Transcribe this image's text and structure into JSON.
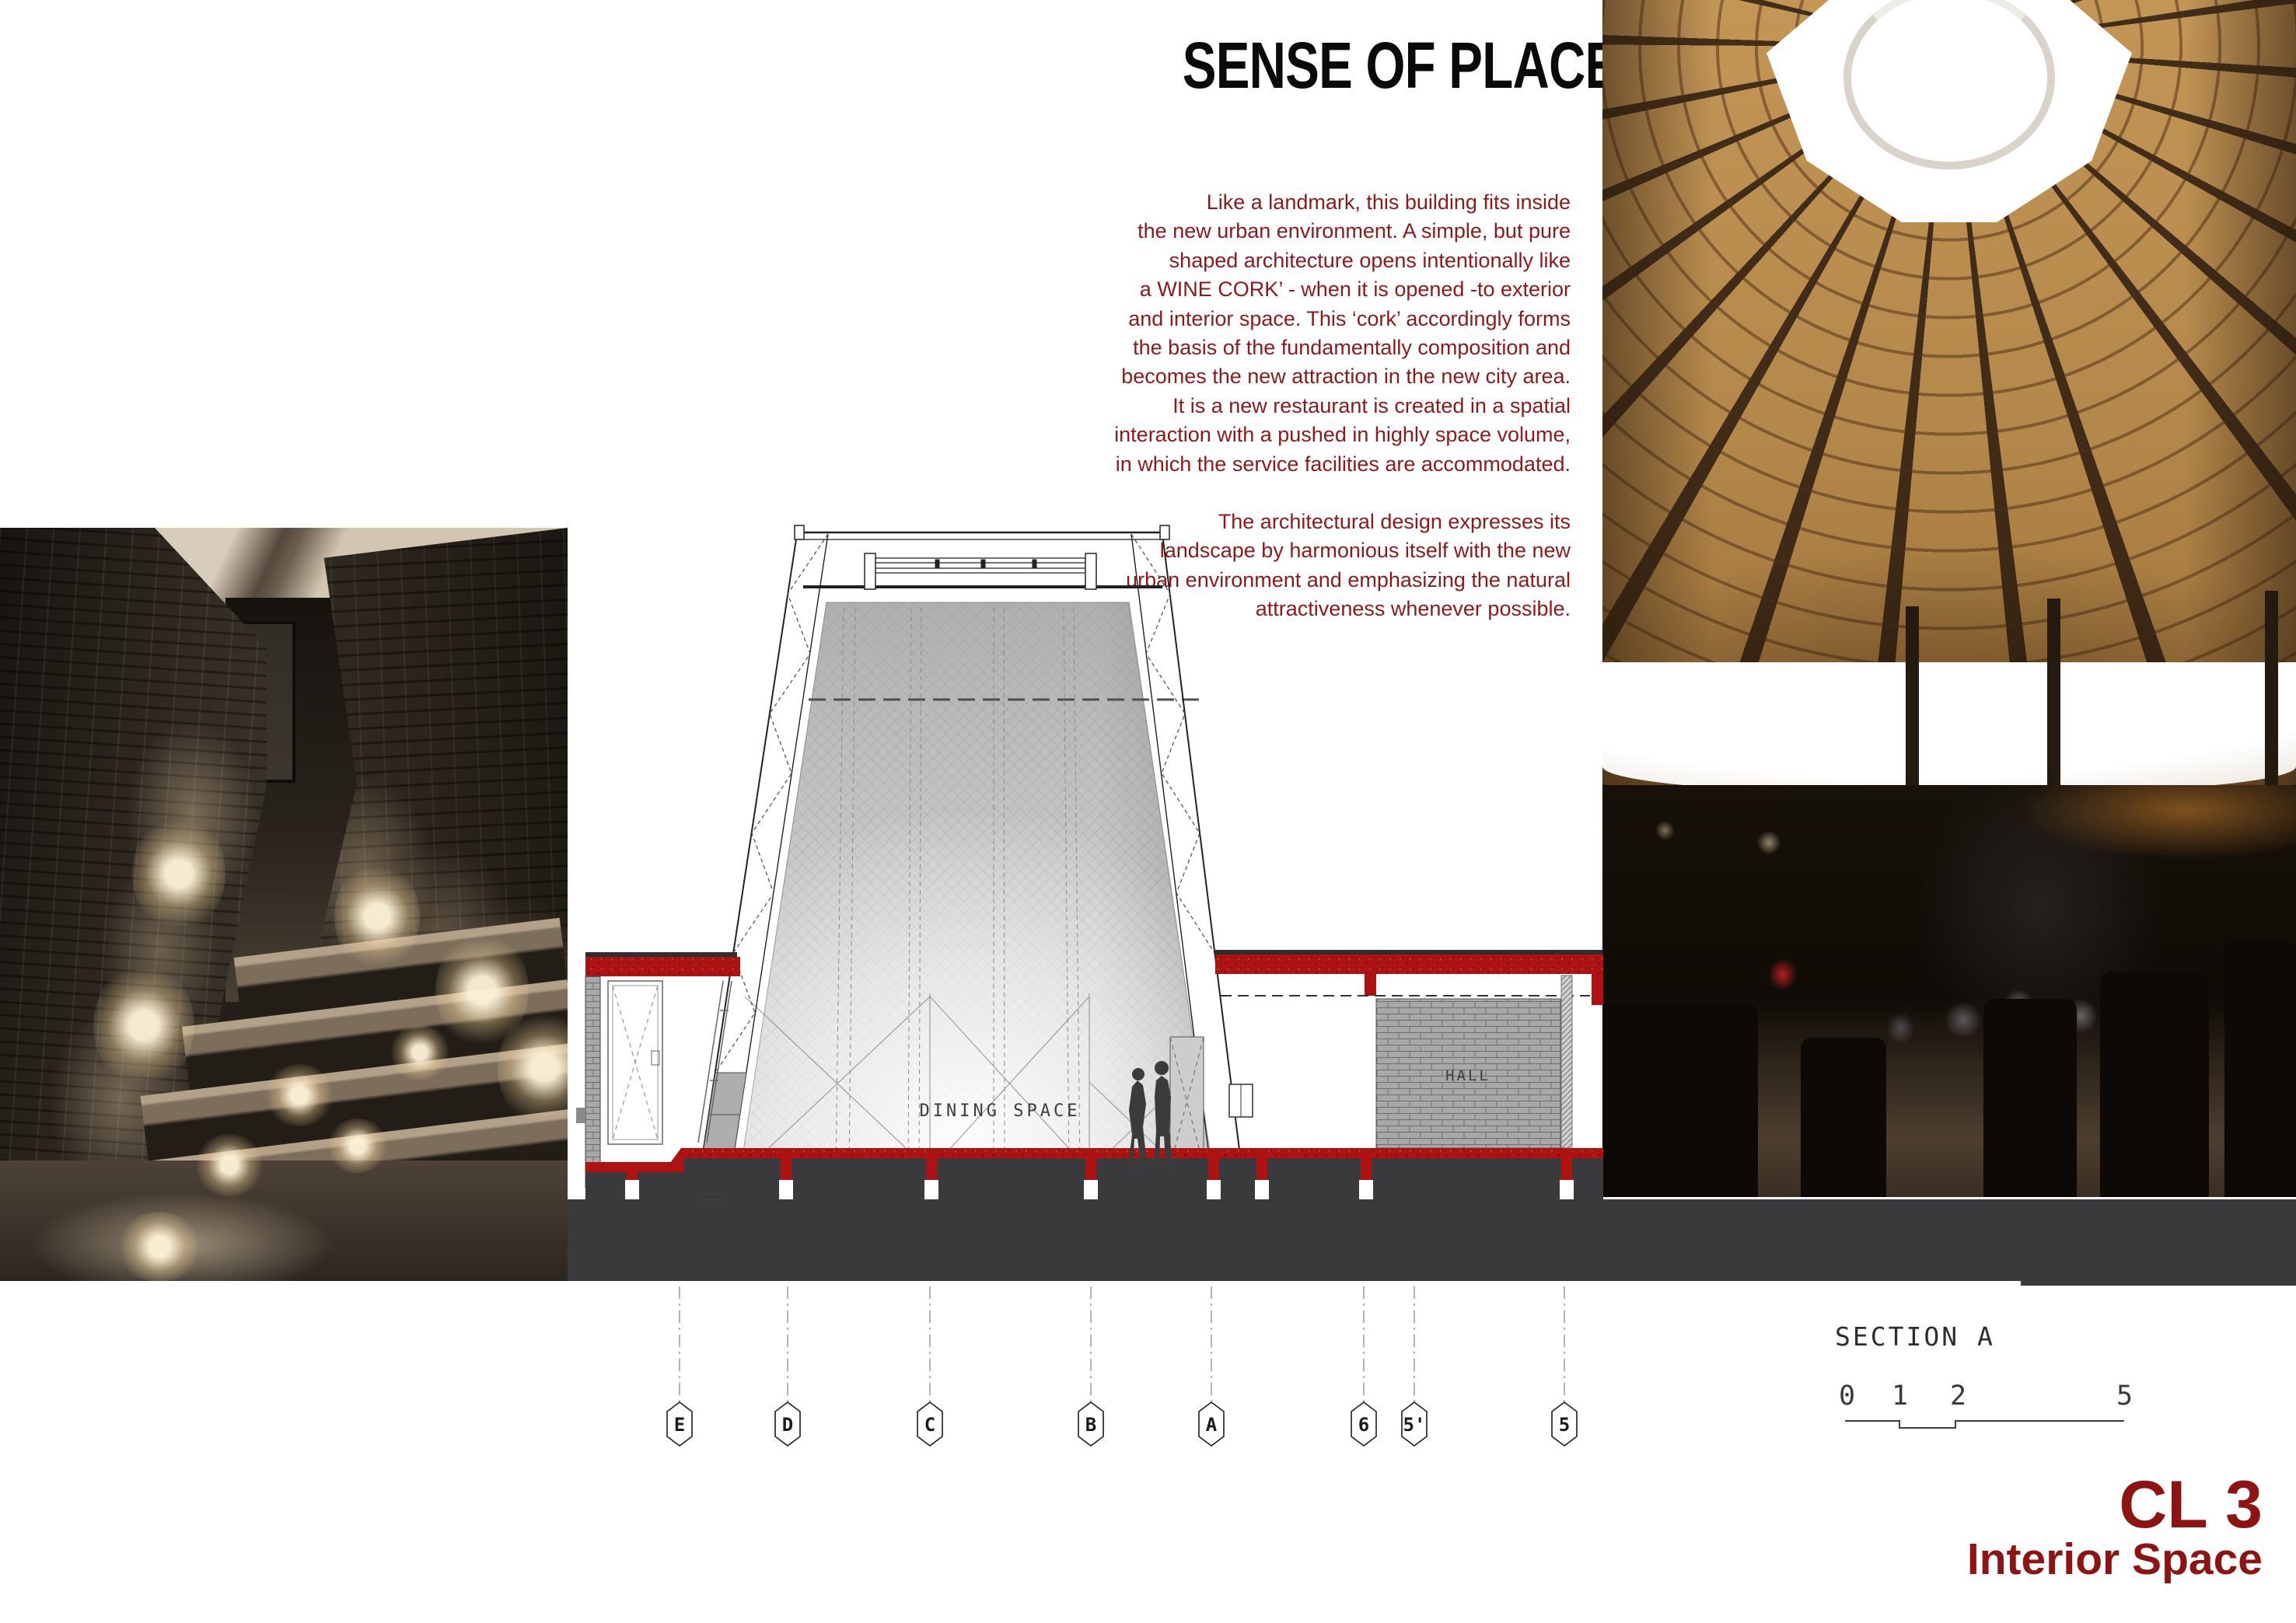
{
  "title": "SENSE OF PLACE",
  "intro": {
    "color": "#8C1A1A",
    "p1": [
      "Like a landmark, this building fits inside",
      "the new urban environment. A simple, but pure",
      "shaped architecture opens intentionally like",
      "a WINE CORK’ - when it is opened -to exterior",
      "and interior space. This ‘cork’ accordingly forms",
      "the basis of the fundamentally composition and",
      "becomes the new attraction in the new city area.",
      "It is a new restaurant is created in a spatial",
      "interaction with a pushed in highly space volume,",
      "in which the service facilities are accommodated."
    ],
    "p2": [
      "The architectural design expresses its",
      "landscape by harmonious itself with the new",
      "urban environment and emphasizing the natural",
      "attractiveness whenever possible."
    ]
  },
  "drawing": {
    "room_labels": {
      "dining": "DINING SPACE",
      "hall": "HALL"
    },
    "grid_markers": [
      "E",
      "D",
      "C",
      "B",
      "A",
      "6",
      "5'",
      "5"
    ],
    "colors": {
      "slab_red": "#AF1212",
      "ground_gray": "#3A3A3C",
      "line": "#2b2b2b"
    }
  },
  "footer": {
    "section_label": "SECTION A",
    "scale_ticks": [
      "0",
      "1",
      "2",
      "5"
    ],
    "sheet_code": "CL 3",
    "sheet_name": "Interior Space",
    "accent": "#8E1414"
  }
}
